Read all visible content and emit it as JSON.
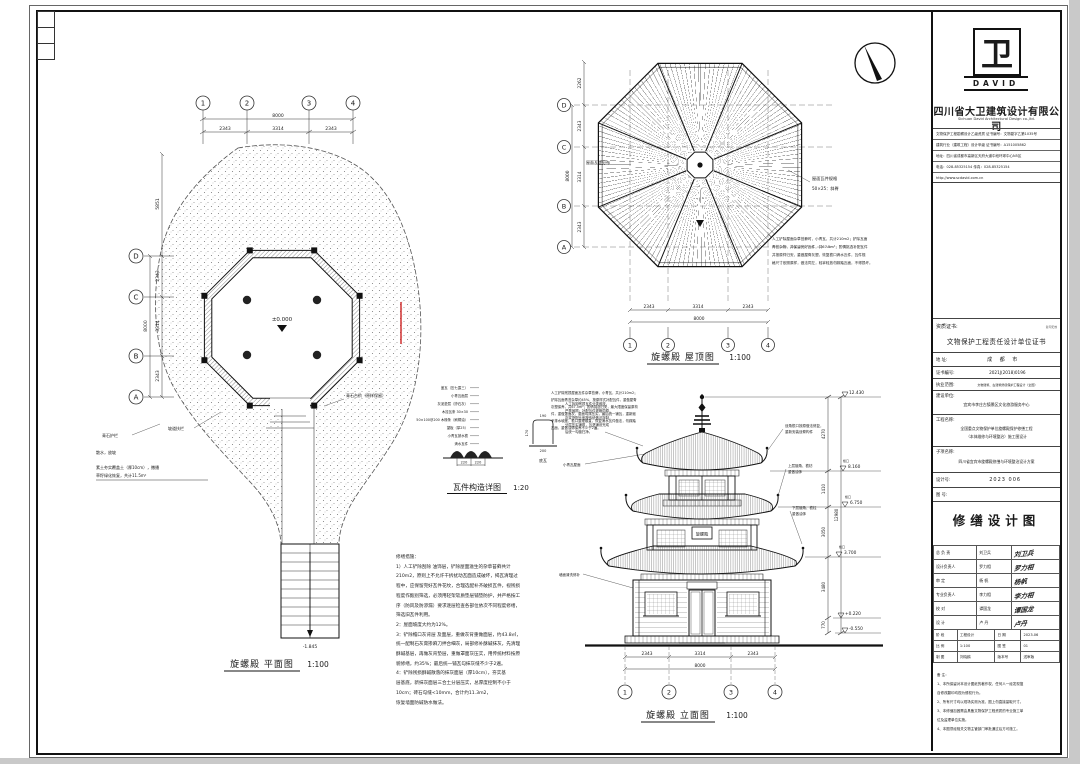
{
  "meta": {
    "accent_red": "#cc2222"
  },
  "plan": {
    "title": "旋螺殿 平面图",
    "scale": "1:100",
    "grid_top": [
      "1",
      "2",
      "3",
      "4"
    ],
    "grid_left": [
      "D",
      "C",
      "B",
      "A"
    ],
    "dims_top": {
      "segments": [
        "2343",
        "3314",
        "2343"
      ],
      "total": "8000"
    },
    "dims_left": {
      "segments": [
        "2343",
        "3314",
        "2343"
      ],
      "total": "8000",
      "extra": "5851"
    },
    "level_center": "±0.000",
    "stair_level": "-1.845",
    "leaders": {
      "ramp": "坡道扶栏",
      "rail": "青石护栏",
      "sanshui": "散水，放坡",
      "soil1": "素土夯实覆盖土（厚10cm），撒播",
      "soil2": "草籽绿化恢复，共计11.5m²",
      "steps": "青石台阶（原样保留）"
    }
  },
  "roof": {
    "title": "旋螺殿 屋顶图",
    "scale": "1:100",
    "grid_bottom": [
      "1",
      "2",
      "3",
      "4"
    ],
    "grid_left": [
      "D",
      "C",
      "B",
      "A"
    ],
    "dims_bottom": {
      "segments": [
        "2343",
        "3314",
        "2343"
      ],
      "total": "8000"
    },
    "dims_left": {
      "segments": [
        "2343",
        "3314",
        "2343"
      ],
      "total": "8000",
      "extra": "2262"
    },
    "tile_spec_1": "屋面瓦件规格",
    "tile_spec_2": "50×25：斜脊",
    "ridge_label": "屋面瓦垄分布",
    "note_lines": [
      "人工铲除屋面杂草苔藓时，小青瓦，共计210m2；铲除瓦面",
      "青苔杂物，并保留完好瓦件，共67.5m²；酌情挑选补配瓦件",
      "并按原样归安，重做屋脊灰塑，恢复檐口滴水瓦件，瓦件规",
      "格尺寸依照原样，做法同左，轻拿轻放勿踩踏瓦面，不得损坏。"
    ]
  },
  "detail": {
    "title": "瓦件构造详图",
    "scale": "1:20",
    "leaders": [
      "盖瓦（压七露三）",
      "小青瓦面层",
      "灰泥垫层（掺石灰）",
      "木挂瓦条 30×30",
      "50×100@200 木椽条（刷桐油）",
      "望板（厚25）",
      "小青瓦披水檐",
      "滴水瓦件"
    ],
    "dims": [
      "220",
      "220"
    ],
    "profile": {
      "top": "190",
      "side": "170",
      "bottom": "200",
      "label": "底瓦"
    },
    "note_lines": [
      "人工拆卸残损瓦件分类堆放，",
      "严禁抛掷；补配瓦件规格同原，",
      "灰浆掺配比例按传统做法拌制，",
      "分层压实铺筑，瓦垄铺设完成",
      "后统一勾缝扫净。"
    ]
  },
  "elevation": {
    "title": "旋螺殿 立面图",
    "scale": "1:100",
    "grid": [
      "1",
      "2",
      "3",
      "4"
    ],
    "dims_bottom": {
      "segments": [
        "2343",
        "3314",
        "2343"
      ],
      "total": "8000"
    },
    "levels": {
      "top": "12.430",
      "eave3": "8.160",
      "eave2": "6.750",
      "eave1": "3.700",
      "step": "+0.220",
      "ground": "-0.550",
      "eave_label": "檐口"
    },
    "vdims": [
      "4270",
      "1410",
      "3050",
      "3480",
      "770"
    ],
    "vtotal": "12980",
    "plaque": "旋螺殿",
    "notes_left": [
      "人工铲除残损屋面瓦件杂草苔藓，小青瓦，共计210m2；",
      "铲除瓦面青苔杂草约45%，按原样式补配瓦件，重做屋脊",
      "灰塑保养，共67.5m²；酌情挑选归安，最大限度保留原构",
      "件，重做罩面灰，屋面勾抹压实，最后统一铺瓦，重新赋",
      "予排水坡度，檐口整理顺直，恢复滴水瓦件做法，勿踩踏",
      "瓦面，重做油饰保养不少于2遍。"
    ],
    "leader_r1a": "戗角檐口按原做法修复，",
    "leader_r1b": "重新安装戗脊构件",
    "leader_r2a": "上层翘角、檐枋",
    "leader_r2b": "重做油饰",
    "leader_r3a": "下层翘角、檐柱",
    "leader_r3b": "重做油饰",
    "leader_l1": "小青瓦屋面",
    "leader_l2": "墙面清洗修补"
  },
  "repair_notes": {
    "lines": [
      "修缮措施：",
      "    1）人工铲除刮除 油饰层，铲除屋面滋生的杂草苔藓共计",
      "210m2，原则上不允许干拆扰动瓦面造成破坏，揭瓦清理过",
      "程中，应保留完好瓦件花纹，合理选配补齐破损瓦件，视残损",
      "程度作甄别筛选，必须用轻架软质垫层铺垫防护，并严格按工",
      "序（防风及防渗漏）要求逐层检查各部位依次不同程度修缮，",
      "筛选旧瓦件利用。",
      "    2：屋面坡度大约为12%。",
      "    3：铲除檐口灰背层 及面层，重做灰背重做面层，约43.8㎡，",
      "统一配制石灰膏掺麻刀拌合细灰，局部修补酥碱抹灰，先清理",
      "酥碱基层，再做灰背垫层，重做罩面灰压实，用传统材料按原",
      "貌修缮，约35%；最后统一铺瓦勾抹灰缝不少于2遍。",
      "    4：铲除残损酥碱散落的抹灰面层（厚10cm），夯实基",
      "层基底，新抹灰面层三合土分层压实，总厚度控制不小于",
      "10cm；砖石勾缝<10mm，合计约11.3m2，",
      "恢复墙面防碱防水做法。"
    ]
  },
  "titleblock": {
    "logo_glyph": "卫",
    "logo_text": "DAVID",
    "company_cn": "四川省大卫建筑设计有限公司",
    "company_en": "Sichuan David Architectural Design co.,ltd.",
    "info_lines": [
      "文物保护工程勘察设计乙级资质 证书编号：文物勘字乙第1035号",
      "建筑行业（建筑工程）设计甲级 证书编号：A151005862",
      "地址：四川省成都市高新区天府大道中段环球中心N5区",
      "电话：028-85325154  传真：028-85325154",
      "http://www.scdavid.com.cn"
    ],
    "cert_label": "资质证书:",
    "cert_note": "复印无效",
    "cert_title": "文物保护工程责任设计单位证书",
    "rows": {
      "addr_label": "地    址:",
      "addr_value": "成 都 市",
      "certno_label": "证书编号:",
      "certno_value": "2021J(2018)0196",
      "scope_label": "执业范围:",
      "scope_value": "文物建筑、古建筑修缮保护工程设计（全国）",
      "client_label": "建设单位:",
      "client_value": "宜宾市李庄古镇景区文化旅游服务中心",
      "project_label": "工程名称:",
      "project_value1": "全国重点文物保护单位旋螺殿保护修缮工程",
      "project_value2": "（本体维修与环境整治）施工图设计",
      "sub_label": "子项名称:",
      "sub_value": "四川省宜宾市旋螺殿修缮与环境整治设计方案",
      "designno_label": "设计号:",
      "designno_value": "2023 006",
      "figno_label": "图  号:",
      "figno_value": ""
    },
    "sheet_title": "修缮设计图",
    "sign_rows": [
      {
        "role": "总 负 责",
        "name": "刘卫兵",
        "sig": "刘卫兵"
      },
      {
        "role": "设计负责人",
        "name": "罗力相",
        "sig": "罗力相"
      },
      {
        "role": "审    定",
        "name": "杨  帆",
        "sig": "杨帆"
      },
      {
        "role": "专业负责人",
        "name": "李力相",
        "sig": "李力相"
      },
      {
        "role": "校    对",
        "name": "谭国龙",
        "sig": "谭国龙"
      },
      {
        "role": "设    计",
        "name": "卢  丹",
        "sig": "卢丹"
      }
    ],
    "meta_rows": [
      {
        "l1": "阶 段",
        "v1": "工程设计",
        "l2": "日 期",
        "v2": "2023.06"
      },
      {
        "l1": "比 例",
        "v1": "1:100",
        "l2": "图 签",
        "v2": "01"
      },
      {
        "l1": "制 图",
        "v1": "刘晓鸥",
        "l2": "版本号",
        "v2": "送审版"
      }
    ],
    "remarks": [
      "备 注：",
      "1、本所保留对本设计图纸的著作权，任何人一经发现擅",
      "    自修改翻印均视为侵权行为。",
      "2、所有尺寸均以现场实测为准，图上勿直接量取尺寸。",
      "3、本修缮加固需由具备文物保护工程资质的专业施工单",
      "    位及监理单位实施。",
      "4、本图须经相关文物主管部门审批通过后方可施工。"
    ]
  }
}
